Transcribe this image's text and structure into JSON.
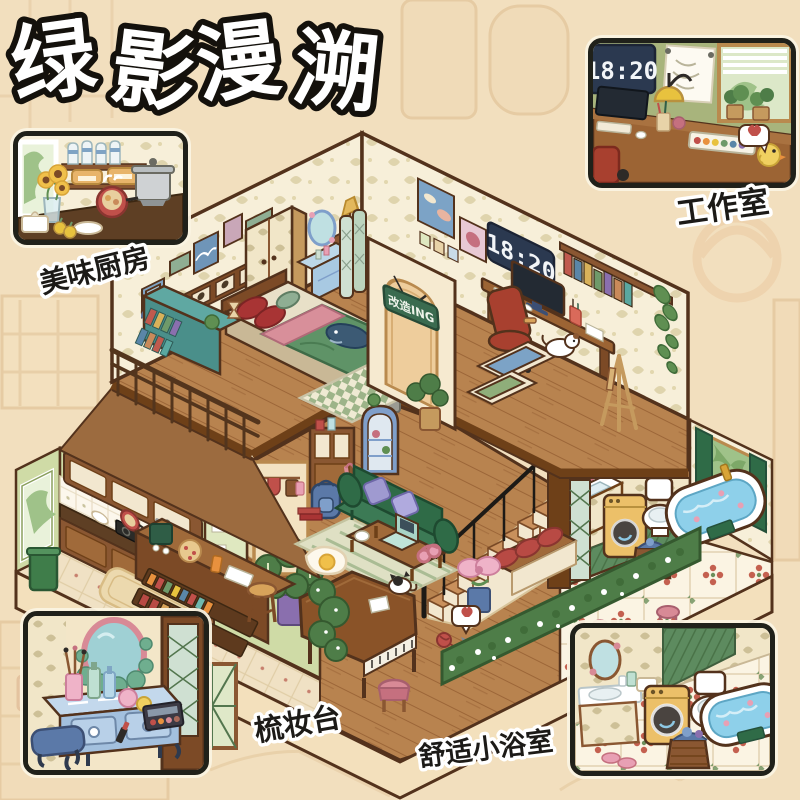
{
  "title": "绿影漫溯",
  "scene": {
    "door_sign": "改造ING",
    "wall_clock_time": "18:20"
  },
  "callouts": {
    "studio": {
      "label": "工作室",
      "clock_time": "18:20"
    },
    "kitchen": {
      "label": "美味厨房"
    },
    "vanity": {
      "label": "梳妆台"
    },
    "bathroom": {
      "label": "舒适小浴室"
    }
  },
  "colors": {
    "background": "#f2dfbe",
    "outline": "#53321c",
    "wall_cream": "#f7efd9",
    "kitchen_green": "#cfdba6",
    "sofa_green": "#2f6b47",
    "wood_floor": "#b8834f",
    "clock_panel": "#2b3950",
    "title_fill": "#ffffff",
    "title_outline": "#14110c",
    "label_fill": "#1c1a17",
    "label_outline": "#ffffff",
    "inset_border": "#20211a"
  }
}
